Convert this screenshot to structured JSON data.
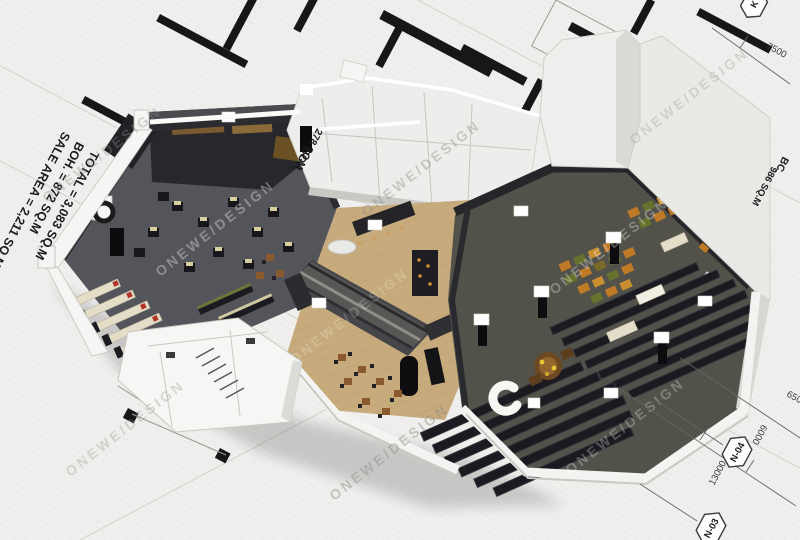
{
  "annotations": {
    "area_summary": {
      "total": "TOTAL = 3,083 SQ.M",
      "boh": "BOH. = 872 SQ.M",
      "sale_area": "SALE AREA = 2,211 SQ.M"
    },
    "boh_top": {
      "name": "BOH.",
      "area": "278 SQ.M"
    },
    "boh_right": {
      "name": "BC.",
      "area": "986 SQ.M"
    }
  },
  "watermark": {
    "text": "ONEWE/DESIGN"
  },
  "blueprint": {
    "grid_bubbles": {
      "n04": "N-04",
      "n03": "N-03",
      "top_right": "K"
    },
    "dimensions": {
      "d7500": "7500",
      "d6500": "6500",
      "d6000": "6000",
      "d13000": "13000"
    }
  },
  "colors": {
    "paper": "#f0efed",
    "ink": "#17171a",
    "wall_white": "#f5f5f3",
    "wall_shade": "#c9c9c4",
    "wall_dark": "#2c2c30",
    "floor_dark": "#54555a",
    "floor_wood": "#c7ab7c",
    "floor_olive": "#53524a",
    "shelf_dark": "#1a1a20",
    "counter_cream": "#e4ddc8",
    "accent_red": "#b3342a",
    "produce_orange": "#bf7a26",
    "produce_green": "#67722e",
    "wood_brown": "#8a5a2e",
    "cap_white": "#ffffff"
  }
}
